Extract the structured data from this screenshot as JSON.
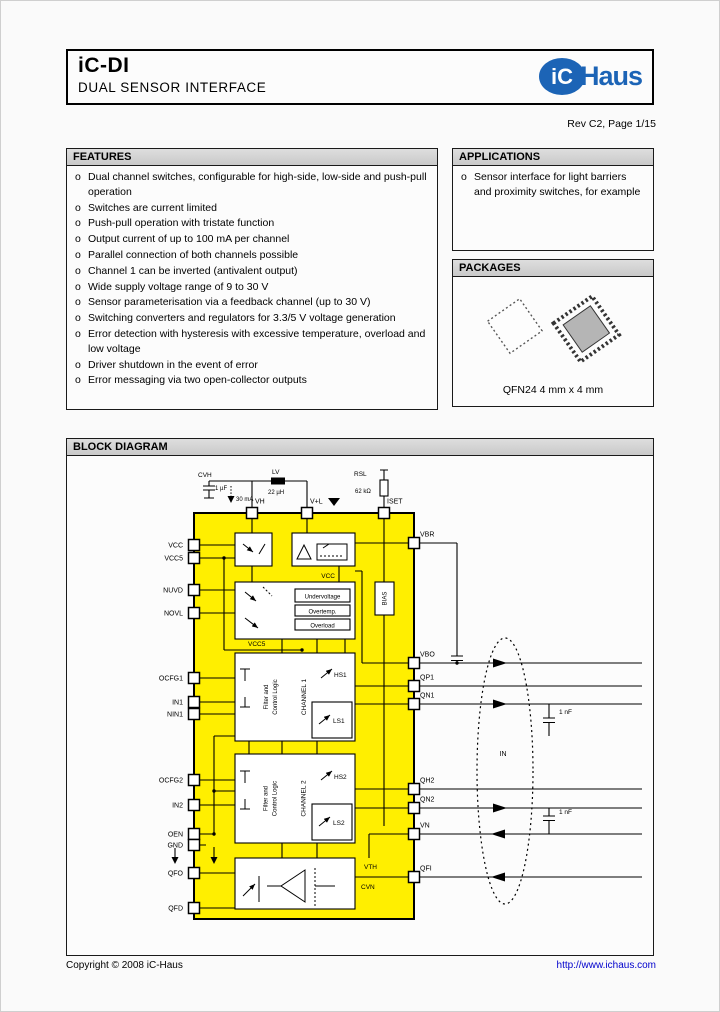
{
  "colors": {
    "accent_blue": "#1c64b6",
    "link_blue": "#0000cc",
    "chip_yellow": "#ffef00"
  },
  "header": {
    "title": "iC-DI",
    "subtitle": "DUAL SENSOR INTERFACE",
    "logo_ic": "iC",
    "logo_haus": "Haus"
  },
  "revision": "Rev C2, Page 1/15",
  "bullet": "o",
  "features": {
    "heading": "FEATURES",
    "items": [
      "Dual channel switches, configurable for high-side, low-side and push-pull operation",
      "Switches are current limited",
      "Push-pull operation with tristate function",
      "Output current of up to 100 mA per channel",
      "Parallel connection of both channels possible",
      "Channel 1 can be inverted (antivalent output)",
      "Wide supply voltage range of 9 to 30 V",
      "Sensor parameterisation via a feedback channel (up to 30 V)",
      "Switching converters and regulators for 3.3/5 V voltage generation",
      "Error detection with hysteresis with excessive temperature, overload and low voltage",
      "Driver shutdown in the event of error",
      "Error messaging via two open-collector outputs"
    ]
  },
  "applications": {
    "heading": "APPLICATIONS",
    "items": [
      "Sensor interface for light barriers and proximity switches, for example"
    ]
  },
  "packages": {
    "heading": "PACKAGES",
    "caption": "QFN24 4 mm x 4 mm"
  },
  "block_diagram": {
    "heading": "BLOCK DIAGRAM",
    "chip": {
      "pins_top": [
        {
          "name": "VH",
          "x": 185
        },
        {
          "name": "V+L",
          "x": 240
        },
        {
          "name": "ISET",
          "x": 317
        }
      ],
      "pins_left": [
        {
          "name": "VCC",
          "y": 89
        },
        {
          "name": "VCC5",
          "y": 102
        },
        {
          "name": "NUVD",
          "y": 134
        },
        {
          "name": "NOVL",
          "y": 157
        },
        {
          "name": "OCFG1",
          "y": 222
        },
        {
          "name": "IN1",
          "y": 246
        },
        {
          "name": "NIN1",
          "y": 258
        },
        {
          "name": "OCFG2",
          "y": 324
        },
        {
          "name": "IN2",
          "y": 349
        },
        {
          "name": "OEN",
          "y": 378
        },
        {
          "name": "GND",
          "y": 389
        },
        {
          "name": "QFO",
          "y": 417
        },
        {
          "name": "QFD",
          "y": 452
        }
      ],
      "pins_right": [
        {
          "name": "VBR",
          "y": 87
        },
        {
          "name": "VBO",
          "y": 207
        },
        {
          "name": "QP1",
          "y": 230
        },
        {
          "name": "QN1",
          "y": 248
        },
        {
          "name": "QH2",
          "y": 333
        },
        {
          "name": "QN2",
          "y": 352
        },
        {
          "name": "VN",
          "y": 378
        },
        {
          "name": "QFI",
          "y": 421
        }
      ]
    },
    "blocks": {
      "undervoltage": "Undervoltage",
      "overtemp": "Overtemp.",
      "overload": "Overload",
      "bias": "BIAS",
      "channel1": "CHANNEL 1",
      "channel2": "CHANNEL 2",
      "filter1": "Filter and",
      "filter2": "Control Logic",
      "hs1": "HS1",
      "ls1": "LS1",
      "hs2": "HS2",
      "ls2": "LS2"
    },
    "labels": {
      "vcc": "VCC",
      "vcc5": "VCC5",
      "vth": "VTH",
      "cvn": "CVN",
      "in": "IN"
    },
    "external": {
      "cvh": "CVH",
      "cvh_value": "1 µF",
      "current": "30 mA",
      "lv": "LV",
      "lv_value": "22 µH",
      "rsl": "RSL",
      "rsl_value": "62 kΩ",
      "cap_qn1": "1 nF",
      "cap_qn2": "1 nF"
    }
  },
  "footer": {
    "copyright": "Copyright © 2008 iC-Haus",
    "url": "http://www.ichaus.com"
  }
}
